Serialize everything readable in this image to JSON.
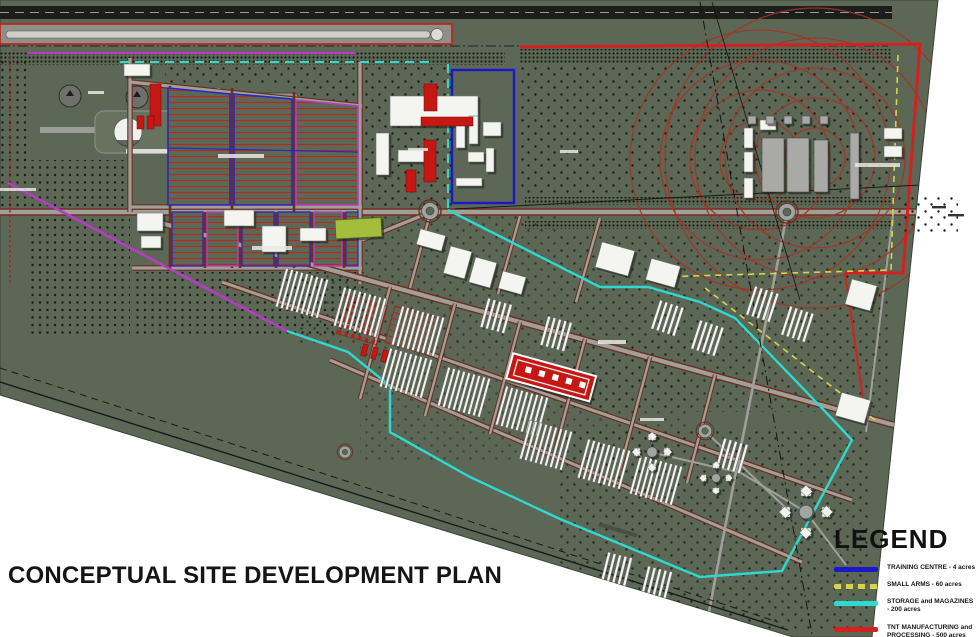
{
  "title": "CONCEPTUAL SITE DEVELOPMENT PLAN",
  "legend": {
    "heading": "LEGEND",
    "items": [
      {
        "l1": "TRAINING CENTRE - 4 acres",
        "l2": "",
        "color": "#1a18c8",
        "swatch_css": "background:#1a18c8"
      },
      {
        "l1": "SMALL ARMS - 60 acres",
        "l2": "",
        "color": "#d8d44a",
        "swatch_css": "background:repeating-linear-gradient(90deg,#d8d44a 0 7px,rgba(0,0,0,0) 7px 12px)"
      },
      {
        "l1": "STORAGE and MAGAZINES - 200 acres",
        "l2": "",
        "color": "#2fd8d0",
        "swatch_css": "background:#2fd8d0"
      },
      {
        "l1": "TNT MANUFACTURING and",
        "l2": "PROCESSING - 500 acres",
        "color": "#d42020",
        "swatch_css": "background:#d42020"
      },
      {
        "l1": "NC PLANT - 75 acres",
        "l2": "",
        "color": "#b63cc6",
        "swatch_css": "background:#b63cc6"
      }
    ]
  },
  "map": {
    "background_color": "#5c6855",
    "tree_color": "#161d15",
    "road_fill": "#a09f99",
    "road_edge": "#6e2f1f",
    "range_ring_color": "#a23427",
    "zone_colors": {
      "training_centre": "#1a18c8",
      "small_arms": "#d8d44a",
      "storage_magazines": "#2fd8d0",
      "tnt_processing": "#d42020",
      "nc_plant": "#b63cc6"
    }
  }
}
